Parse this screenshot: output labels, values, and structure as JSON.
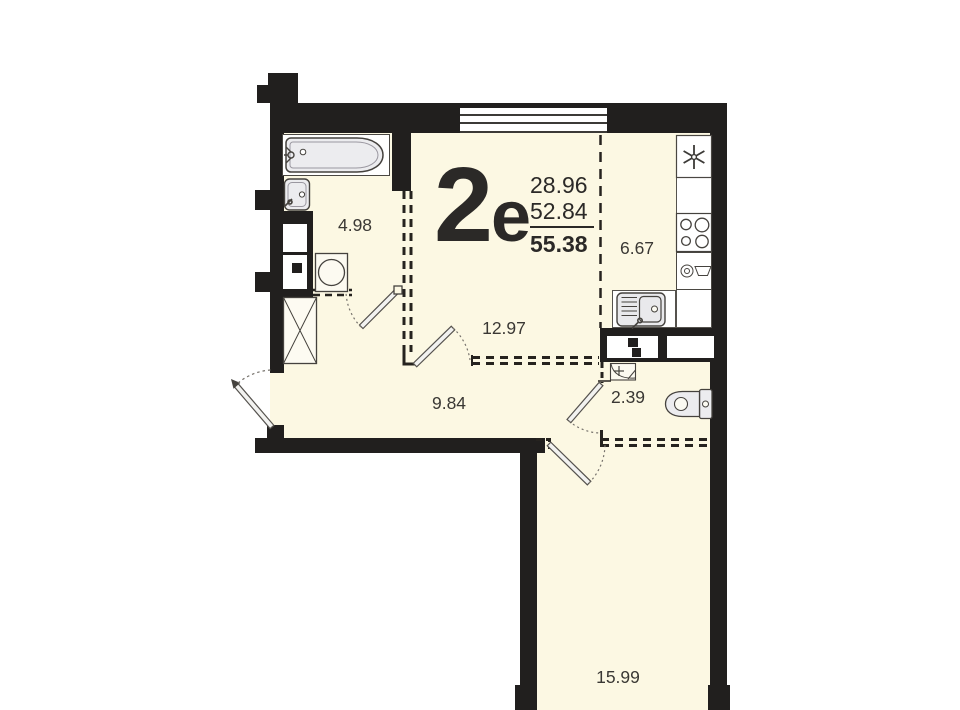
{
  "unit": {
    "number": "2",
    "type_letter": "е",
    "area_living": "28.96",
    "area_extra": "52.84",
    "area_total": "55.38"
  },
  "rooms": {
    "bathroom": {
      "area": "4.98"
    },
    "kitchen": {
      "area": "6.67"
    },
    "living": {
      "area": "12.97"
    },
    "hall": {
      "area": "9.84"
    },
    "wc": {
      "area": "2.39"
    },
    "room": {
      "area": "15.99"
    }
  },
  "colors": {
    "wall": "#211f1e",
    "floor": "#fcf8e3",
    "fixture_fill": "#ececef",
    "text_dark": "#2b2927",
    "text_room": "#3a3834",
    "white": "#ffffff"
  }
}
